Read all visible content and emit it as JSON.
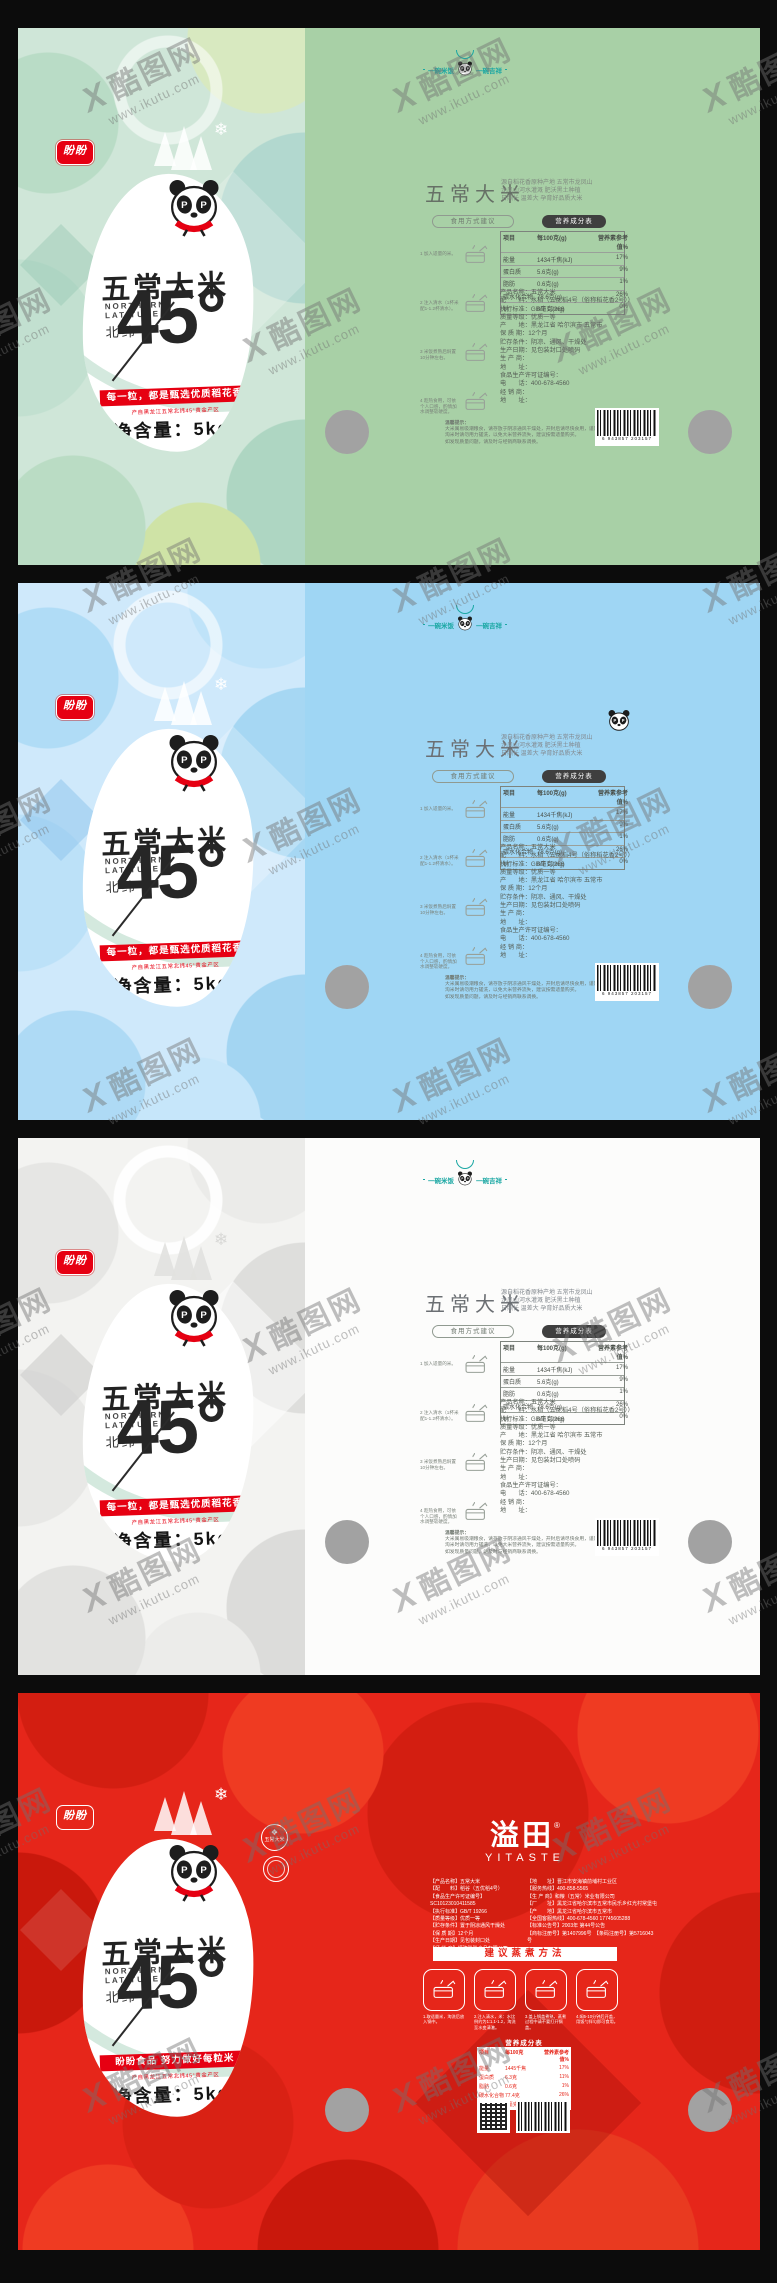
{
  "watermark": {
    "mark": "X",
    "brand": "酷图网",
    "url": "www.ikutu.com"
  },
  "palette": {
    "green_back": "#a8d0a6",
    "blue_back": "#9fd6f4",
    "white_back": "#fcfcfb",
    "red_base": "#e6261a",
    "banner_red": "#e60012",
    "logo_teal": "#1aa7a3",
    "hole_gray": "#a2a2a2"
  },
  "front": {
    "brand": "盼盼",
    "title": "五常大米",
    "en1": "NORTHERN",
    "en2": "LATITUDE",
    "lat_label": "北纬",
    "lat_value": "45°",
    "banner": "每一粒，都是甄选优质稻花香",
    "banner_red": "盼盼食品  努力做好每粒米",
    "origin": "产自黑龙江五常北纬45°黄金产区",
    "net": "净含量：5kg",
    "snowflake": "❄",
    "badge1": "五常大米"
  },
  "back": {
    "slogan_left": "一碗米饭",
    "slogan_right": "一碗吉祥",
    "title": "五常大米",
    "desc": [
      "源自稻花香原种产地 五常市龙凤山",
      "龙凤山河水灌溉 肥沃黑土种植",
      "日照长 温差大 孕育好品质大米"
    ],
    "usage": "食用方式建议",
    "steps": [
      {
        "t": "1 加入适量的米。"
      },
      {
        "t": "2 注入清水（1杯米 配1-1.2杯清水）。"
      },
      {
        "t": "3 米饭煮熟后焖置 10分钟左右。"
      },
      {
        "t": "4 趁热食用，可依个人口感，酌情加水调整软硬度。"
      }
    ],
    "nut_title": "营养成分表",
    "nut_cols": [
      "项目",
      "每100克(g)",
      "营养素参考值%"
    ],
    "nut_rows": [
      [
        "能量",
        "1434千焦(kJ)",
        "17%"
      ],
      [
        "蛋白质",
        "5.6克(g)",
        "9%"
      ],
      [
        "脂肪",
        "0.6克(g)",
        "1%"
      ],
      [
        "碳水化合物",
        "78.6克(g)",
        "26%"
      ],
      [
        "钠",
        "0毫克(mg)",
        "0%"
      ]
    ],
    "info": [
      "产品名称：五常大米",
      "配　　料：水稻（五优稻4号（俗称稻花香2号））",
      "执行标准：GB/T 19266",
      "质量等级：优质一等",
      "产　　地：黑龙江省 哈尔滨市 五常市",
      "保 质 期：12个月",
      "贮存条件：阴凉、通风、干燥处",
      "生产日期：见包装封口处喷码",
      "生 产 商：",
      "地　　址：",
      "食品生产许可证编号：",
      "电　　话：400-678-4560",
      "经 销 商：",
      "地　　址："
    ],
    "tips_title": "温馨提示：",
    "tips": [
      "大米属易吸潮粮食，请存放于阴凉通风干燥处，开封后请尽快食用，谨防大米受潮发霉变质。",
      "淘米时请勿用力搓洗，以免大米营养流失，建议按需适量购买。",
      "如发现质量问题，请及时与经销商联系调换。"
    ],
    "barcode": "6 943857 203157"
  },
  "red_back": {
    "logo": "溢田",
    "reg": "®",
    "logo_en": "YITASTE",
    "info_left": [
      "【产品名称】五常大米",
      "【配　　料】稻谷（五优稻4号）",
      "【食品生产许可证编号】SC10123010411585",
      "【执行标准】GB/T 19266",
      "【质量等级】优质一等",
      "【贮存条件】置于阴凉通风干燥处",
      "【保 质 期】12个月",
      "【生产日期】见包装封口处",
      "【经 销 商】福建盼盼食品有限公司"
    ],
    "info_right": [
      "【地　　址】晋江市安海镇前埔村工业区",
      "【服务热线】400-858-5565",
      "【生 产 商】和粮（五常）米业有限公司",
      "【厂　　址】黑龙江省哈尔滨市五常市民乐乡红光村常堡屯",
      "【产　　地】黑龙江省哈尔滨市五常市",
      "【全国客服热线】400-678-4560  17745605288",
      "【标准公告号】2003年 第44号公告",
      "【商标注册号】第1407996号　【条码注册号】第5716043号"
    ],
    "method": "建议蒸煮方法",
    "steps": [
      {
        "t": "1.取适量米，淘洗后放入锅中。"
      },
      {
        "t": "2.注入清水，米：水比例约为1:1.1-1.2，淘洗至水变清澈。"
      },
      {
        "t": "3.盖上锅盖煮熟，蒸煮过程中请不要打开锅盖。"
      },
      {
        "t": "4.焖5-10分钟后开盖，用饭勺拌匀即可食用。"
      }
    ],
    "nut_title": "营养成分表",
    "nut_cols": [
      "项目",
      "每100克",
      "营养素参考值%"
    ],
    "nut_rows": [
      [
        "能量",
        "1445千焦",
        "17%"
      ],
      [
        "蛋白质",
        "6.3克",
        "11%"
      ],
      [
        "脂肪",
        "0.6克",
        "1%"
      ],
      [
        "碳水化合物",
        "77.4克",
        "26%"
      ],
      [
        "钠",
        "0毫克",
        "0%"
      ]
    ]
  }
}
